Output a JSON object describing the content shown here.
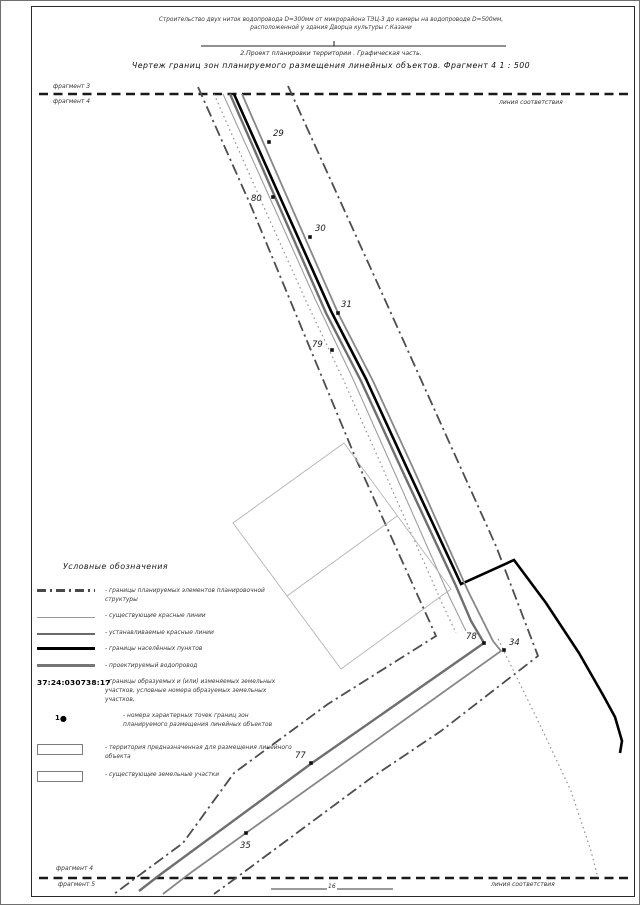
{
  "titles": {
    "line1": "Строительство двух ниток водопровода D=300мм от микрорайона ТЭЦ-3 до камеры на водопроводе D=500мм,",
    "line2": "расположенной у здания Дворца культуры г.Казани",
    "line3": "2.Проект планировки территории . Графическая часть.",
    "line4": "Чертеж границ зон планируемого размещения линейных объектов. Фрагмент 4    1 : 500"
  },
  "edge_labels": {
    "top_above": "фрагмент 3",
    "top_below": "фрагмент 4",
    "top_right": "линия соответствия",
    "bottom_above": "фрагмент 4",
    "bottom_below": "фрагмент 5",
    "bottom_right": "линия соответствия",
    "scale_mark": "16"
  },
  "legend": {
    "header": "Условные обозначения",
    "items": [
      {
        "symbol": "dashdot-line",
        "text": "- границы планируемых элементов планировочной структуры"
      },
      {
        "symbol": "thin-line",
        "text": "- существующие красные линии"
      },
      {
        "symbol": "medium-line",
        "text": "- устанавливаемые красные линии"
      },
      {
        "symbol": "thick-black-line",
        "text": "- границы населённых пунктов"
      },
      {
        "symbol": "thick-gray-line",
        "text": "- проектируемый водопровод"
      },
      {
        "symbol": "cadastral-number",
        "text": "- границы образуемых и (или) изменяемых земельных участков, условные номера образуемых земельных участков,"
      },
      {
        "symbol": "point-number",
        "text": "- номера характерных точек границ зон планируемого размещения линейных объектов"
      },
      {
        "symbol": "white-rect",
        "text": "- территория предназначенная для размещения линейного объекта"
      },
      {
        "symbol": "white-rect",
        "text": "- существующие земельные участки"
      }
    ],
    "cadastral_number": "37:24:030738:17",
    "point_number_example": "1",
    "point_number_dot": "●"
  },
  "map": {
    "lines": [
      {
        "name": "top-correspondence-line",
        "type": "dashed",
        "color": "#1a1a1a",
        "w": 2.6,
        "pts": [
          [
            38,
            93
          ],
          [
            632,
            93
          ]
        ]
      },
      {
        "name": "bottom-correspondence-line",
        "type": "dashed",
        "color": "#1a1a1a",
        "w": 2.6,
        "pts": [
          [
            38,
            877
          ],
          [
            632,
            877
          ]
        ]
      },
      {
        "name": "planning-boundary-left",
        "type": "dashdot",
        "color": "#4d4d4d",
        "w": 1.8,
        "pts": [
          [
            197,
            86
          ],
          [
            250,
            205
          ],
          [
            355,
            458
          ],
          [
            435,
            635
          ],
          [
            327,
            703
          ],
          [
            233,
            772
          ],
          [
            182,
            842
          ],
          [
            140,
            873
          ],
          [
            113,
            893
          ]
        ]
      },
      {
        "name": "planning-boundary-right",
        "type": "dashdot",
        "color": "#4d4d4d",
        "w": 1.8,
        "pts": [
          [
            287,
            85
          ],
          [
            380,
            290
          ],
          [
            495,
            545
          ],
          [
            537,
            655
          ],
          [
            440,
            730
          ],
          [
            370,
            777
          ],
          [
            235,
            877
          ],
          [
            213,
            893
          ]
        ]
      },
      {
        "name": "settlement-boundary",
        "type": "solid",
        "color": "#000000",
        "w": 2.6,
        "pts": [
          [
            233,
            93
          ],
          [
            283,
            205
          ],
          [
            330,
            310
          ],
          [
            365,
            378
          ],
          [
            405,
            465
          ],
          [
            460,
            583
          ],
          [
            513,
            559
          ],
          [
            545,
            602
          ],
          [
            578,
            652
          ],
          [
            602,
            694
          ],
          [
            614,
            716
          ],
          [
            621,
            740
          ],
          [
            619,
            752
          ]
        ]
      },
      {
        "name": "projected-waterline",
        "type": "solid",
        "color": "#6f6f6f",
        "w": 2.4,
        "pts": [
          [
            229,
            93
          ],
          [
            278,
            205
          ],
          [
            325,
            312
          ],
          [
            360,
            380
          ],
          [
            400,
            467
          ],
          [
            455,
            585
          ],
          [
            470,
            620
          ],
          [
            483,
            642
          ],
          [
            311,
            762
          ],
          [
            160,
            873
          ],
          [
            138,
            890
          ]
        ]
      },
      {
        "name": "established-red-line-right",
        "type": "solid",
        "color": "#878787",
        "w": 1.8,
        "pts": [
          [
            241,
            93
          ],
          [
            290,
            205
          ],
          [
            337,
            312
          ],
          [
            372,
            380
          ],
          [
            412,
            467
          ],
          [
            467,
            590
          ],
          [
            492,
            640
          ],
          [
            500,
            650
          ],
          [
            245,
            832
          ],
          [
            188,
            873
          ],
          [
            162,
            893
          ]
        ]
      },
      {
        "name": "existing-red-line-left",
        "type": "solid",
        "color": "#9e9e9e",
        "w": 1.1,
        "pts": [
          [
            222,
            93
          ],
          [
            268,
            195
          ],
          [
            315,
            300
          ],
          [
            352,
            378
          ],
          [
            392,
            468
          ],
          [
            448,
            595
          ],
          [
            465,
            630
          ]
        ]
      },
      {
        "name": "existing-boundary-dotted-1",
        "type": "dotted",
        "color": "#8c8c8c",
        "w": 1.1,
        "pts": [
          [
            213,
            93
          ],
          [
            258,
            195
          ],
          [
            305,
            300
          ],
          [
            342,
            378
          ],
          [
            383,
            470
          ],
          [
            440,
            600
          ],
          [
            455,
            632
          ]
        ]
      },
      {
        "name": "existing-boundary-dotted-2",
        "type": "dotted",
        "color": "#8c8c8c",
        "w": 1.1,
        "pts": [
          [
            497,
            638
          ],
          [
            540,
            726
          ],
          [
            570,
            790
          ],
          [
            590,
            850
          ],
          [
            597,
            877
          ]
        ]
      },
      {
        "name": "parcel-outline",
        "type": "solid",
        "color": "#b4b4b4",
        "w": 0.9,
        "closed": true,
        "pts": [
          [
            343,
            442
          ],
          [
            232,
            522
          ],
          [
            340,
            668
          ],
          [
            450,
            588
          ]
        ]
      },
      {
        "name": "parcel-divider",
        "type": "solid",
        "color": "#b4b4b4",
        "w": 0.9,
        "pts": [
          [
            286,
            595
          ],
          [
            396,
            515
          ]
        ]
      },
      {
        "name": "title-separator",
        "type": "solid",
        "color": "#222222",
        "w": 1,
        "pts": [
          [
            200,
            45
          ],
          [
            505,
            45
          ]
        ]
      },
      {
        "name": "title-separator-tick",
        "type": "solid",
        "color": "#222222",
        "w": 1,
        "pts": [
          [
            333,
            40
          ],
          [
            333,
            45
          ]
        ]
      },
      {
        "name": "scale-bar-left",
        "type": "solid",
        "color": "#7a7a7a",
        "w": 1.4,
        "pts": [
          [
            270,
            888
          ],
          [
            326,
            888
          ]
        ]
      },
      {
        "name": "scale-bar-right",
        "type": "solid",
        "color": "#7a7a7a",
        "w": 1.4,
        "pts": [
          [
            336,
            888
          ],
          [
            392,
            888
          ]
        ]
      }
    ],
    "points": [
      {
        "n": "29",
        "x": 268,
        "y": 141,
        "lx": 272,
        "ly": 135
      },
      {
        "n": "80",
        "x": 272,
        "y": 196,
        "lx": 250,
        "ly": 200
      },
      {
        "n": "30",
        "x": 309,
        "y": 236,
        "lx": 314,
        "ly": 230
      },
      {
        "n": "31",
        "x": 337,
        "y": 312,
        "lx": 340,
        "ly": 306
      },
      {
        "n": "79",
        "x": 331,
        "y": 349,
        "lx": 311,
        "ly": 346
      },
      {
        "n": "78",
        "x": 483,
        "y": 642,
        "lx": 465,
        "ly": 638
      },
      {
        "n": "34",
        "x": 503,
        "y": 649,
        "lx": 508,
        "ly": 644
      },
      {
        "n": "77",
        "x": 310,
        "y": 762,
        "lx": 294,
        "ly": 757
      },
      {
        "n": "35",
        "x": 245,
        "y": 832,
        "lx": 239,
        "ly": 847
      }
    ]
  }
}
